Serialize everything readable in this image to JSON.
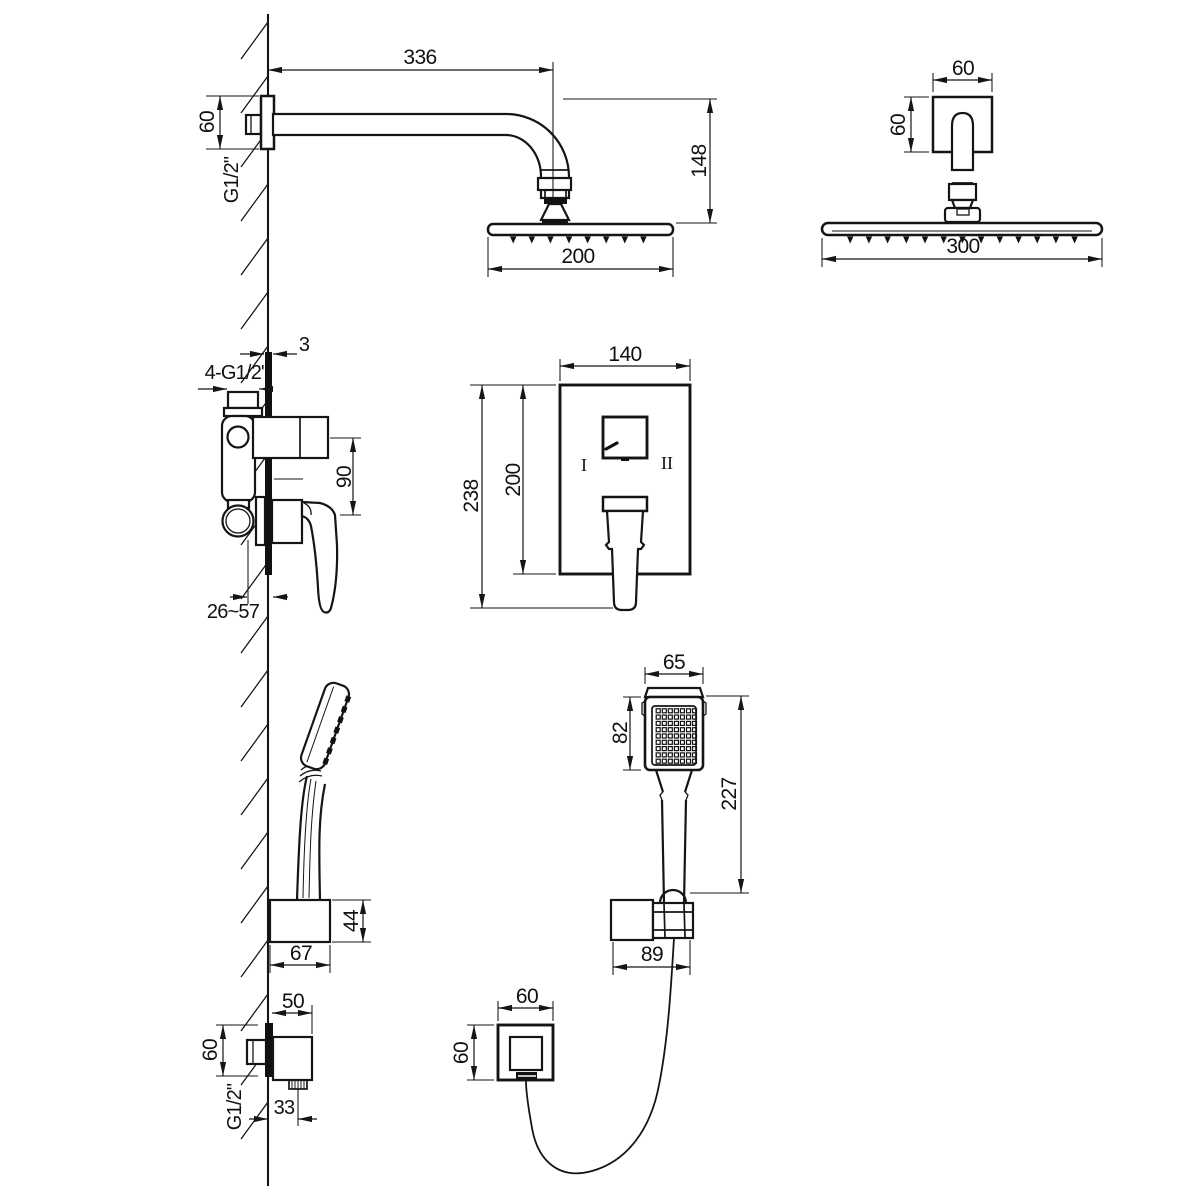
{
  "drawing": {
    "background": "#ffffff",
    "line_color": "#151515",
    "views": {
      "rainSide": {
        "armLength": "336",
        "flangeSize": "60",
        "thread": "G1/2\"",
        "headDrop": "148",
        "headWidth": "200"
      },
      "rainFront": {
        "flangeWidth": "60",
        "flangeHeight": "60",
        "headWidth": "300"
      },
      "mixer": {
        "plateThickness": "3",
        "connections": "4-G1/2\"",
        "portSpacing": "90",
        "depthRange": "26~57"
      },
      "plate": {
        "width": "140",
        "heightTotal": "238",
        "heightPlate": "200",
        "mode1": "I",
        "mode2": "II"
      },
      "holder": {
        "width": "67",
        "height": "44"
      },
      "handShower": {
        "headWidth": "65",
        "faceHeight": "82",
        "totalLength": "227",
        "bracketWidth": "89"
      },
      "outletSide": {
        "depth": "50",
        "flangeHeight": "60",
        "offset": "33",
        "thread": "G1/2\""
      },
      "outletFront": {
        "width": "60",
        "height": "60"
      }
    }
  }
}
